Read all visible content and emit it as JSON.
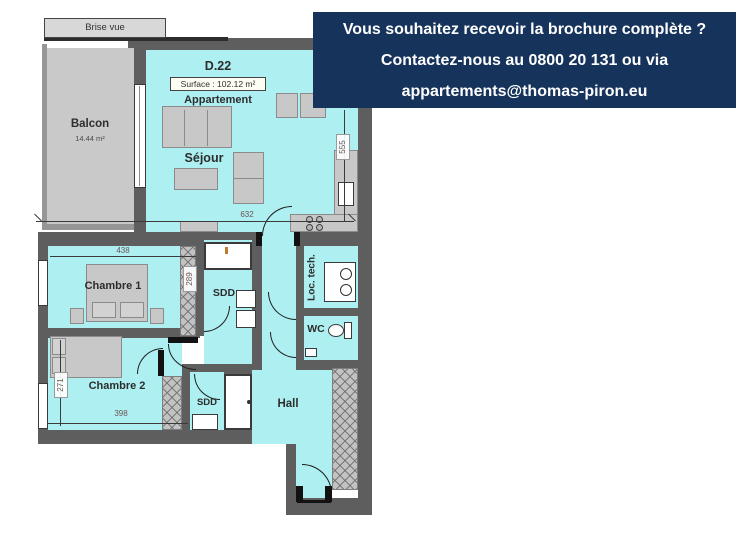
{
  "banner": {
    "line1": "Vous souhaitez recevoir la brochure complète ?",
    "line2": "Contactez-nous au 0800 20 131 ou via",
    "line3": "appartements@thomas-piron.eu"
  },
  "unit": {
    "id": "D.22",
    "surface": "Surface : 102.12 m²",
    "type": "Appartement"
  },
  "rooms": {
    "balcony": {
      "name": "Balcon",
      "area": "14.44 m²"
    },
    "living": {
      "name": "Séjour"
    },
    "bedroom1": {
      "name": "Chambre 1"
    },
    "bedroom2": {
      "name": "Chambre 2"
    },
    "shower_top": {
      "name": "SDD"
    },
    "shower_bottom": {
      "name": "SDD"
    },
    "wc": {
      "name": "WC"
    },
    "tech": {
      "name": "Loc. tech."
    },
    "hall": {
      "name": "Hall"
    }
  },
  "annotations": {
    "brise_vue": "Brise vue"
  },
  "dimensions": {
    "living_width_cm": "632",
    "living_depth_cm": "555",
    "bedroom1_width_cm": "438",
    "bedroom1_depth_cm": "289",
    "bedroom2_width_cm": "398",
    "bedroom2_depth_cm": "271"
  },
  "colors": {
    "banner_bg": "#16335c",
    "room_fill": "#aeeff1",
    "wall": "#5e5e5e",
    "balcony_fill": "#c9c9c9"
  }
}
